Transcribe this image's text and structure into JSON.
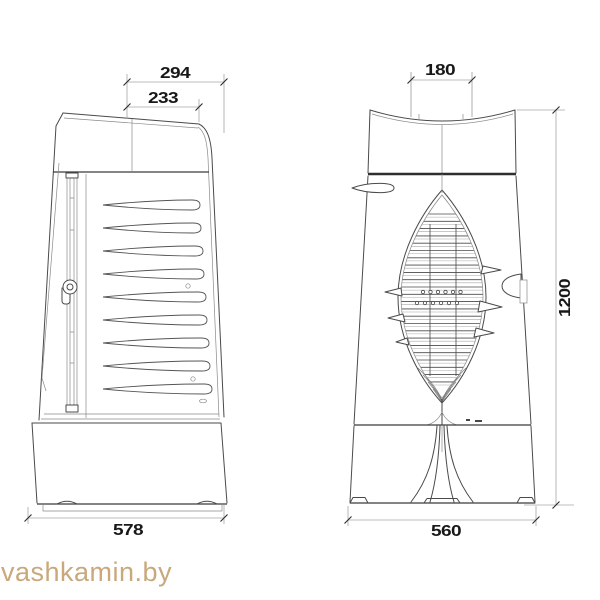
{
  "window": {
    "width": 600,
    "height": 600,
    "background": "#ffffff"
  },
  "drawing": {
    "type": "technical-drawing",
    "outline_color": "#4a4a4a",
    "dimension_line_color": "#a6a6a6",
    "dimension_text_color": "#181818",
    "dimensions": {
      "side_top_overall": "294",
      "side_top_lid": "233",
      "side_base_depth": "578",
      "front_flue_width": "180",
      "front_overall_height": "1200",
      "front_base_width": "560"
    }
  },
  "watermark": {
    "text": "vashkamin.by",
    "color": "#c9a87b"
  }
}
